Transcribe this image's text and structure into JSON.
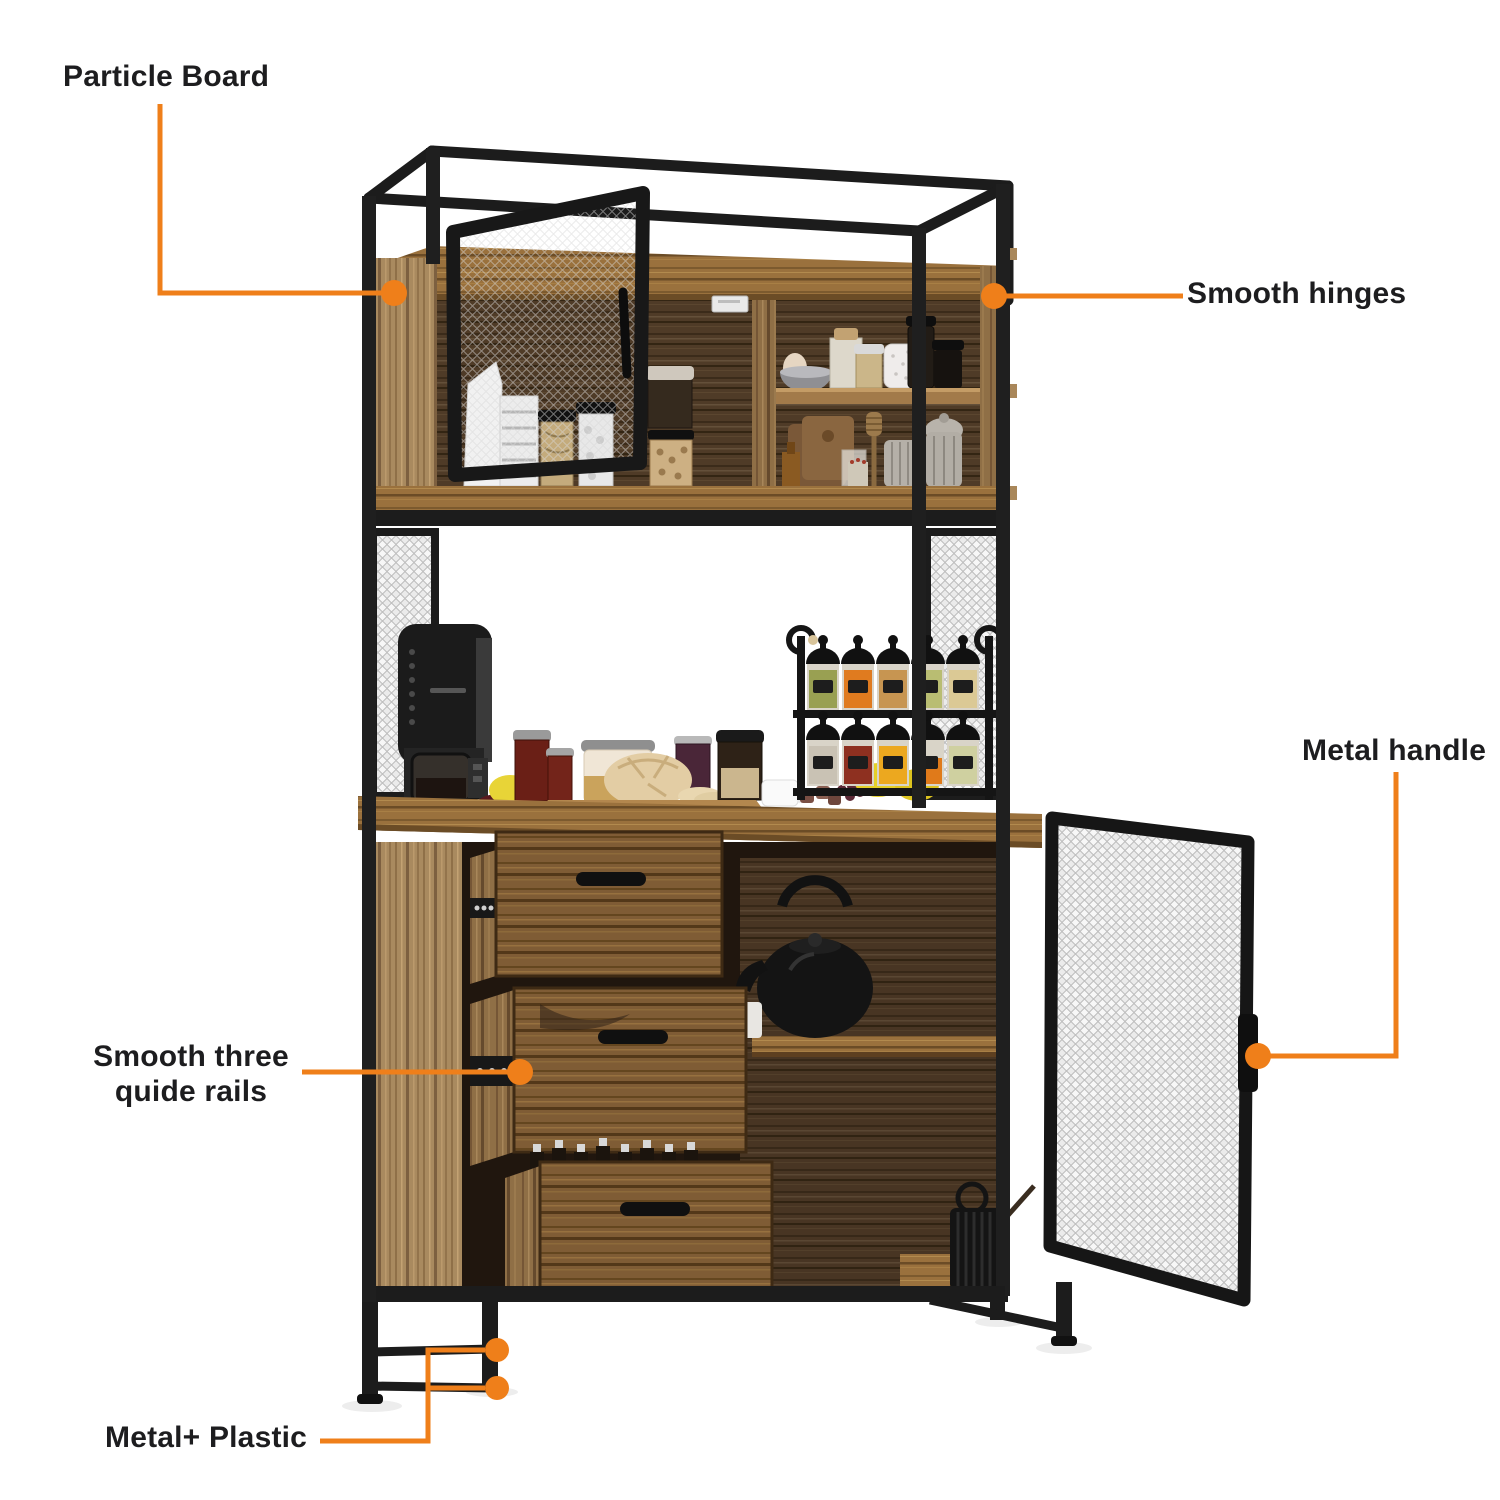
{
  "callouts": {
    "particle_board": {
      "label": "Particle Board"
    },
    "smooth_hinges": {
      "label": "Smooth hinges"
    },
    "metal_handle": {
      "label": "Metal handle"
    },
    "guide_rails": {
      "line1": "Smooth three",
      "line2": "quide rails"
    },
    "metal_plastic": {
      "label": "Metal+ Plastic"
    }
  },
  "colors": {
    "accent": "#EF7F1A",
    "ink": "#1d1d1f",
    "frame_black": "#1c1c1c",
    "mesh_light": "#ebebeb",
    "wood_light": "#a98a5f",
    "wood_mid": "#7f5c35",
    "wood_dark": "#4f3b27",
    "counter": "#9a713d"
  }
}
